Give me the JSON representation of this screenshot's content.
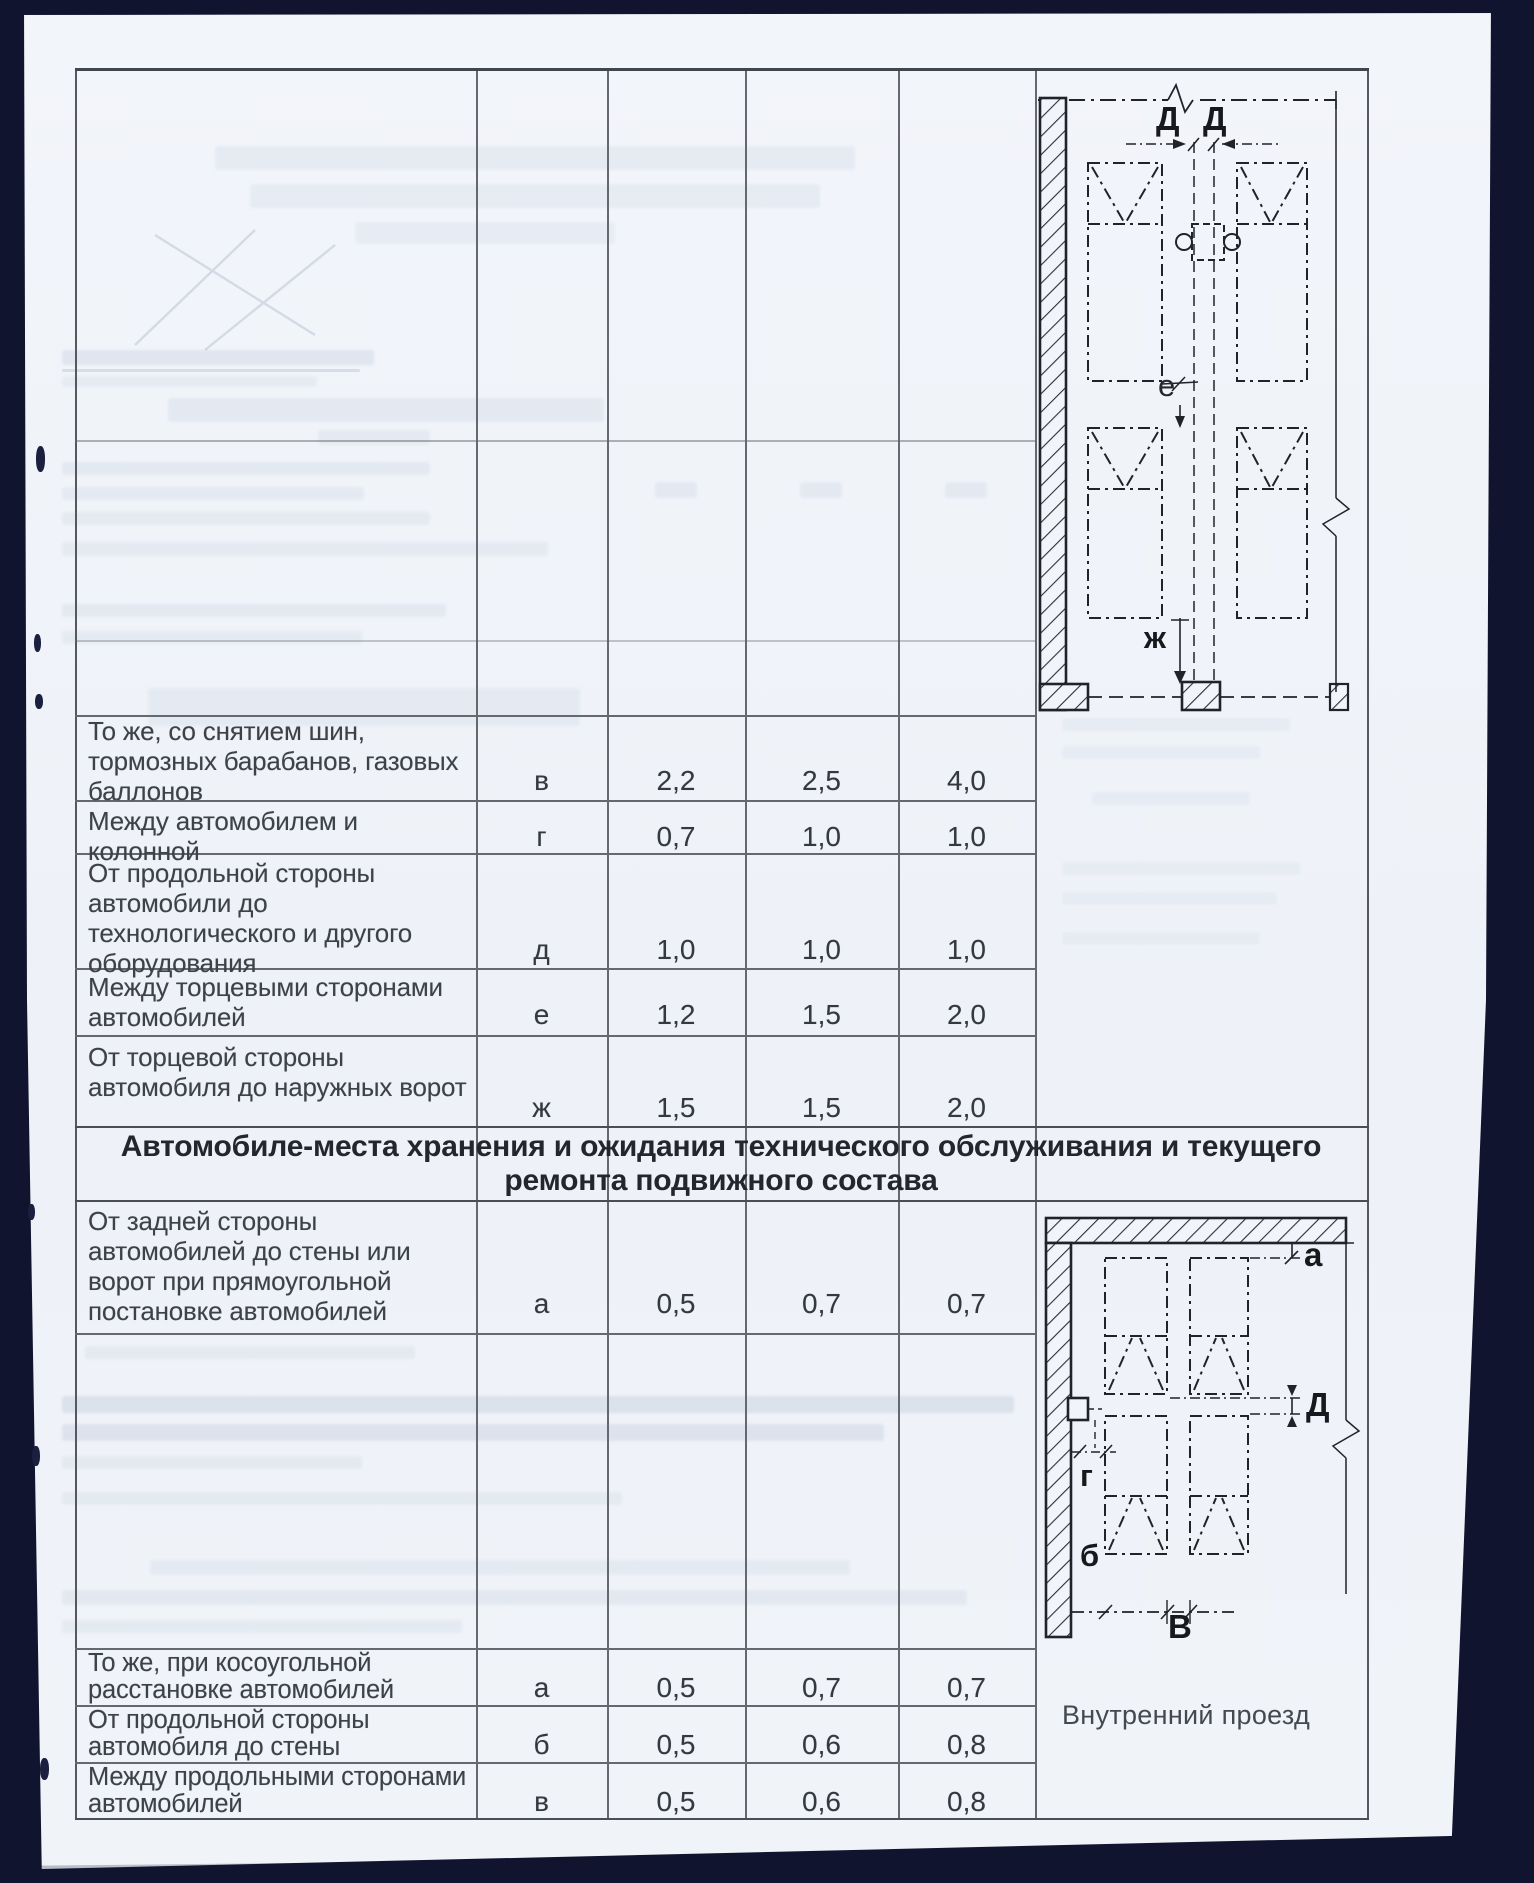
{
  "document": {
    "section_header_line1": "Автомобиле-места хранения и ожидания технического обслуживания и текущего",
    "section_header_line2": "ремонта подвижного состава",
    "diagram_caption": "Внутренний проезд"
  },
  "table": {
    "rows_upper": [
      {
        "description": "То же, со снятием шин, тормозных барабанов, газовых баллонов",
        "letter": "в",
        "values": [
          "2,2",
          "2,5",
          "4,0"
        ]
      },
      {
        "description": "Между автомобилем и колонной",
        "letter": "г",
        "values": [
          "0,7",
          "1,0",
          "1,0"
        ]
      },
      {
        "description": "От продольной стороны автомобили до технологического и другого оборудования",
        "letter": "д",
        "values": [
          "1,0",
          "1,0",
          "1,0"
        ]
      },
      {
        "description": "Между торцевыми сторонами автомобилей",
        "letter": "е",
        "values": [
          "1,2",
          "1,5",
          "2,0"
        ]
      },
      {
        "description": "От торцевой стороны автомобиля до наружных ворот",
        "letter": "ж",
        "values": [
          "1,5",
          "1,5",
          "2,0"
        ]
      }
    ],
    "rows_lower": [
      {
        "description": "От задней стороны автомобилей до стены или ворот при прямоугольной постановке автомобилей",
        "letter": "а",
        "values": [
          "0,5",
          "0,7",
          "0,7"
        ]
      },
      {
        "description": "То же, при косоугольной расстановке автомобилей",
        "letter": "а",
        "values": [
          "0,5",
          "0,7",
          "0,7"
        ]
      },
      {
        "description": "От продольной стороны автомобиля до стены",
        "letter": "б",
        "values": [
          "0,5",
          "0,6",
          "0,8"
        ]
      },
      {
        "description": "Между продольными сторонами автомобилей",
        "letter": "в",
        "values": [
          "0,5",
          "0,6",
          "0,8"
        ]
      }
    ]
  },
  "diagrams": {
    "top": {
      "dim_d1": "Д",
      "dim_d2": "Д",
      "dim_e": "е",
      "dim_zh": "ж"
    },
    "bottom": {
      "dim_a": "а",
      "dim_d": "Д",
      "dim_g": "г",
      "dim_b": "б",
      "dim_v": "В"
    }
  },
  "colors": {
    "page": "#f1f4f9",
    "scan_border": "#10142f",
    "rule": "#65686e",
    "text": "#3d4249"
  }
}
